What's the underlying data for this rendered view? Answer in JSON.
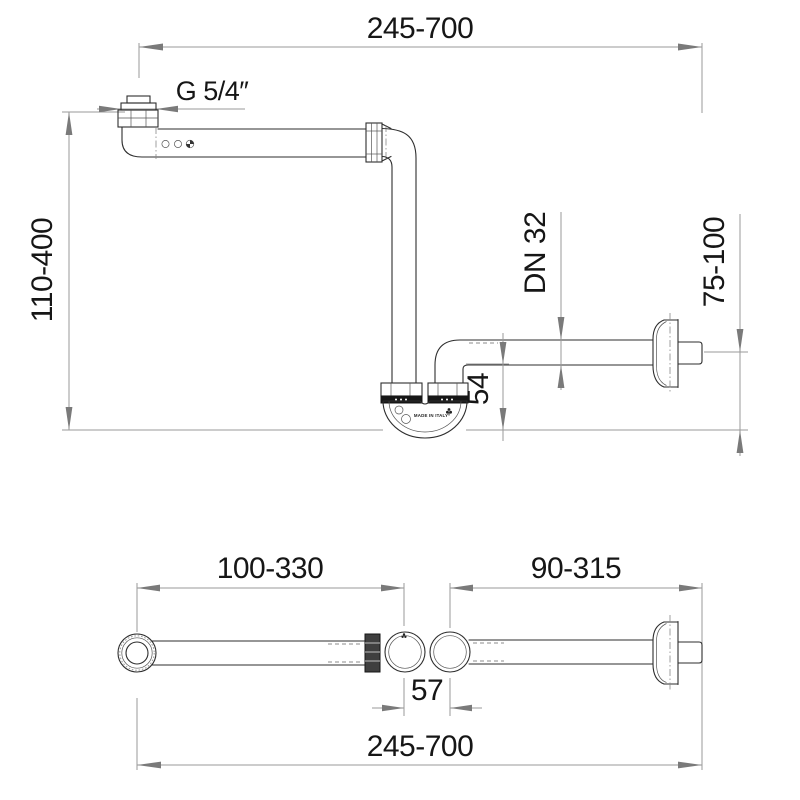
{
  "drawing": {
    "type": "technical-dimension-drawing",
    "subject": "space-saving bottle trap with wall outlet",
    "line_color": "#2e2e2e",
    "dim_color": "#9a9a9a",
    "dims": {
      "top_span": "245-700",
      "inlet_thread": "G 5/4″",
      "height_range": "110-400",
      "outlet_dn": "DN 32",
      "wall_height_range": "75-100",
      "trap_drop": "54",
      "inlet_arm_range": "100-330",
      "outlet_arm_range": "90-315",
      "port_spacing": "57",
      "bottom_span": "245-700"
    },
    "branding": {
      "made_in": "MADE IN ITALY"
    }
  }
}
